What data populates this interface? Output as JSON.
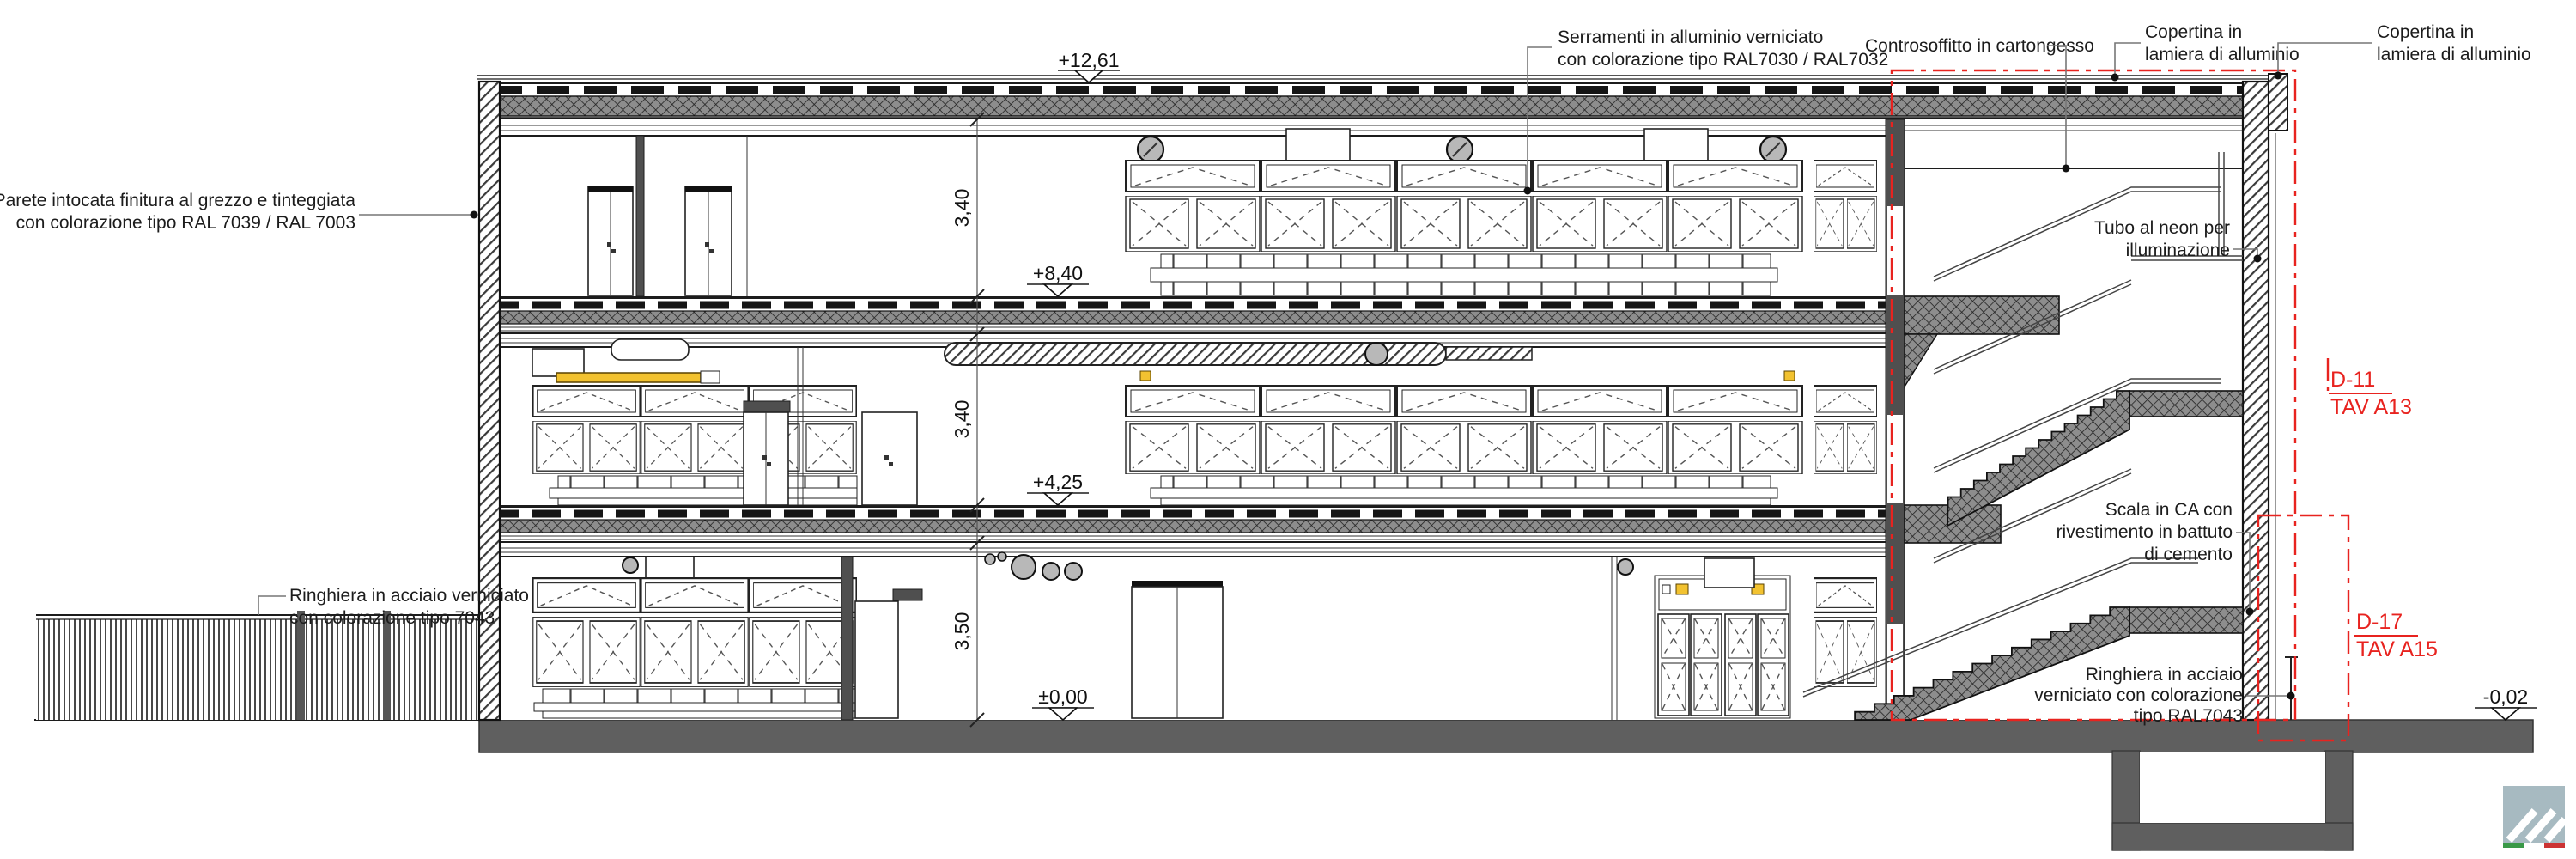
{
  "drawing": {
    "title": "Sezione architettonica edificio",
    "annotations": {
      "parete": {
        "lines": [
          "Parete intocata finitura al grezzo e tinteggiata",
          "con colorazione tipo RAL 7039 / RAL 7003"
        ]
      },
      "serramenti": {
        "lines": [
          "Serramenti in alluminio verniciato",
          "con colorazione tipo RAL7030 / RAL7032"
        ]
      },
      "controsoffitto": {
        "lines": [
          "Controsoffitto in cartongesso"
        ]
      },
      "copertina_sx": {
        "lines": [
          "Copertina in",
          "lamiera di alluminio"
        ]
      },
      "copertina_dx": {
        "lines": [
          "Copertina in",
          "lamiera di alluminio"
        ]
      },
      "tubo_neon": {
        "lines": [
          "Tubo al neon per",
          "illuminazione"
        ]
      },
      "scala": {
        "lines": [
          "Scala in CA con",
          "rivestimento in battuto",
          "di cemento"
        ]
      },
      "ringhiera_dx": {
        "lines": [
          "Ringhiera in acciaio",
          "verniciato con colorazione",
          "tipo RAL7043"
        ]
      },
      "ringhiera_sx": {
        "lines": [
          "Ringhiera in acciaio verniciato",
          "con colorazione tipo 7043"
        ]
      }
    },
    "levels": {
      "copertura": "+12,61",
      "piano2": "+8,40",
      "piano1": "+4,25",
      "terra": "±0,00",
      "esterno": "-0,02"
    },
    "dimensions": {
      "piano2_h": "3,40",
      "piano1_h": "3,40",
      "terra_h": "3,50"
    },
    "details": {
      "d11": {
        "code": "D-11",
        "tav": "TAV A13"
      },
      "d17": {
        "code": "D-17",
        "tav": "TAV A15"
      }
    },
    "colors": {
      "detail_red": "#e8231f",
      "neon_yellow": "#f2c230",
      "logo_bg": "#a7bac1",
      "flag_green": "#3a9948",
      "flag_red": "#cc3333"
    }
  }
}
